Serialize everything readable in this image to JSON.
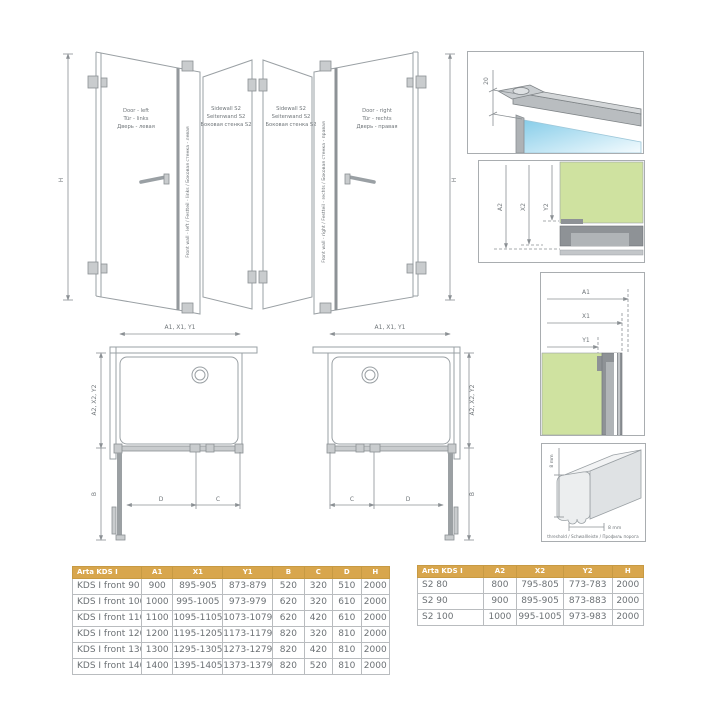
{
  "colors": {
    "header_bg": "#d8a64d",
    "header_text": "#ffffff",
    "glass_green": "#cfe2a0",
    "glass_blue": "#87cde9",
    "profile_gray": "#8e9296",
    "line_gray": "#8b9094",
    "cell_text": "#6c7175"
  },
  "diagrams": {
    "left_elevation": {
      "door_label": [
        "Door - left",
        "Tür - links",
        "Дверь - левая"
      ],
      "front_wall_label": "Front wall - left / Festteil - links / Боковая стенка - левая",
      "sidewall_label": [
        "Sidewall S2",
        "Seitenwand S2",
        "Боковая стенка S2"
      ],
      "height": "H"
    },
    "right_elevation": {
      "door_label": [
        "Door - right",
        "Tür - rechts",
        "Дверь - правая"
      ],
      "front_wall_label": "Front wall - right / Festteil - rechts / Боковая стенка - правая",
      "sidewall_label": [
        "Sidewall S2",
        "Seitenwand S2",
        "Боковая стенка S2"
      ],
      "height": "H"
    },
    "top_detail": {
      "dim": "20"
    },
    "sidewall_detail": {
      "dims": [
        "A2",
        "X2",
        "Y2"
      ]
    },
    "front_detail": {
      "dims": [
        "A1",
        "X1",
        "Y1"
      ]
    },
    "threshold": {
      "height_dim": "8 mm",
      "width_dim": "8 mm",
      "caption": "threshold / Schwallleiste / Профиль порога"
    },
    "plan_left": {
      "top_dim": "A1, X1, Y1",
      "side_dim": "A2, X2, Y2",
      "b": "B",
      "c": "C",
      "d": "D"
    },
    "plan_right": {
      "top_dim": "A1, X1, Y1",
      "side_dim": "A2, X2, Y2",
      "b": "B",
      "c": "C",
      "d": "D"
    }
  },
  "left_table": {
    "headers": [
      "Arta KDS I",
      "A1",
      "X1",
      "Y1",
      "B",
      "C",
      "D",
      "H"
    ],
    "rows": [
      [
        "KDS I front 90",
        "900",
        "895-905",
        "873-879",
        "520",
        "320",
        "510",
        "2000"
      ],
      [
        "KDS I front 100",
        "1000",
        "995-1005",
        "973-979",
        "620",
        "320",
        "610",
        "2000"
      ],
      [
        "KDS I front 110",
        "1100",
        "1095-1105",
        "1073-1079",
        "620",
        "420",
        "610",
        "2000"
      ],
      [
        "KDS I front 120",
        "1200",
        "1195-1205",
        "1173-1179",
        "820",
        "320",
        "810",
        "2000"
      ],
      [
        "KDS I front 130",
        "1300",
        "1295-1305",
        "1273-1279",
        "820",
        "420",
        "810",
        "2000"
      ],
      [
        "KDS I front 140",
        "1400",
        "1395-1405",
        "1373-1379",
        "820",
        "520",
        "810",
        "2000"
      ]
    ]
  },
  "right_table": {
    "headers": [
      "Arta KDS I",
      "A2",
      "X2",
      "Y2",
      "H"
    ],
    "rows": [
      [
        "S2 80",
        "800",
        "795-805",
        "773-783",
        "2000"
      ],
      [
        "S2 90",
        "900",
        "895-905",
        "873-883",
        "2000"
      ],
      [
        "S2 100",
        "1000",
        "995-1005",
        "973-983",
        "2000"
      ]
    ]
  }
}
